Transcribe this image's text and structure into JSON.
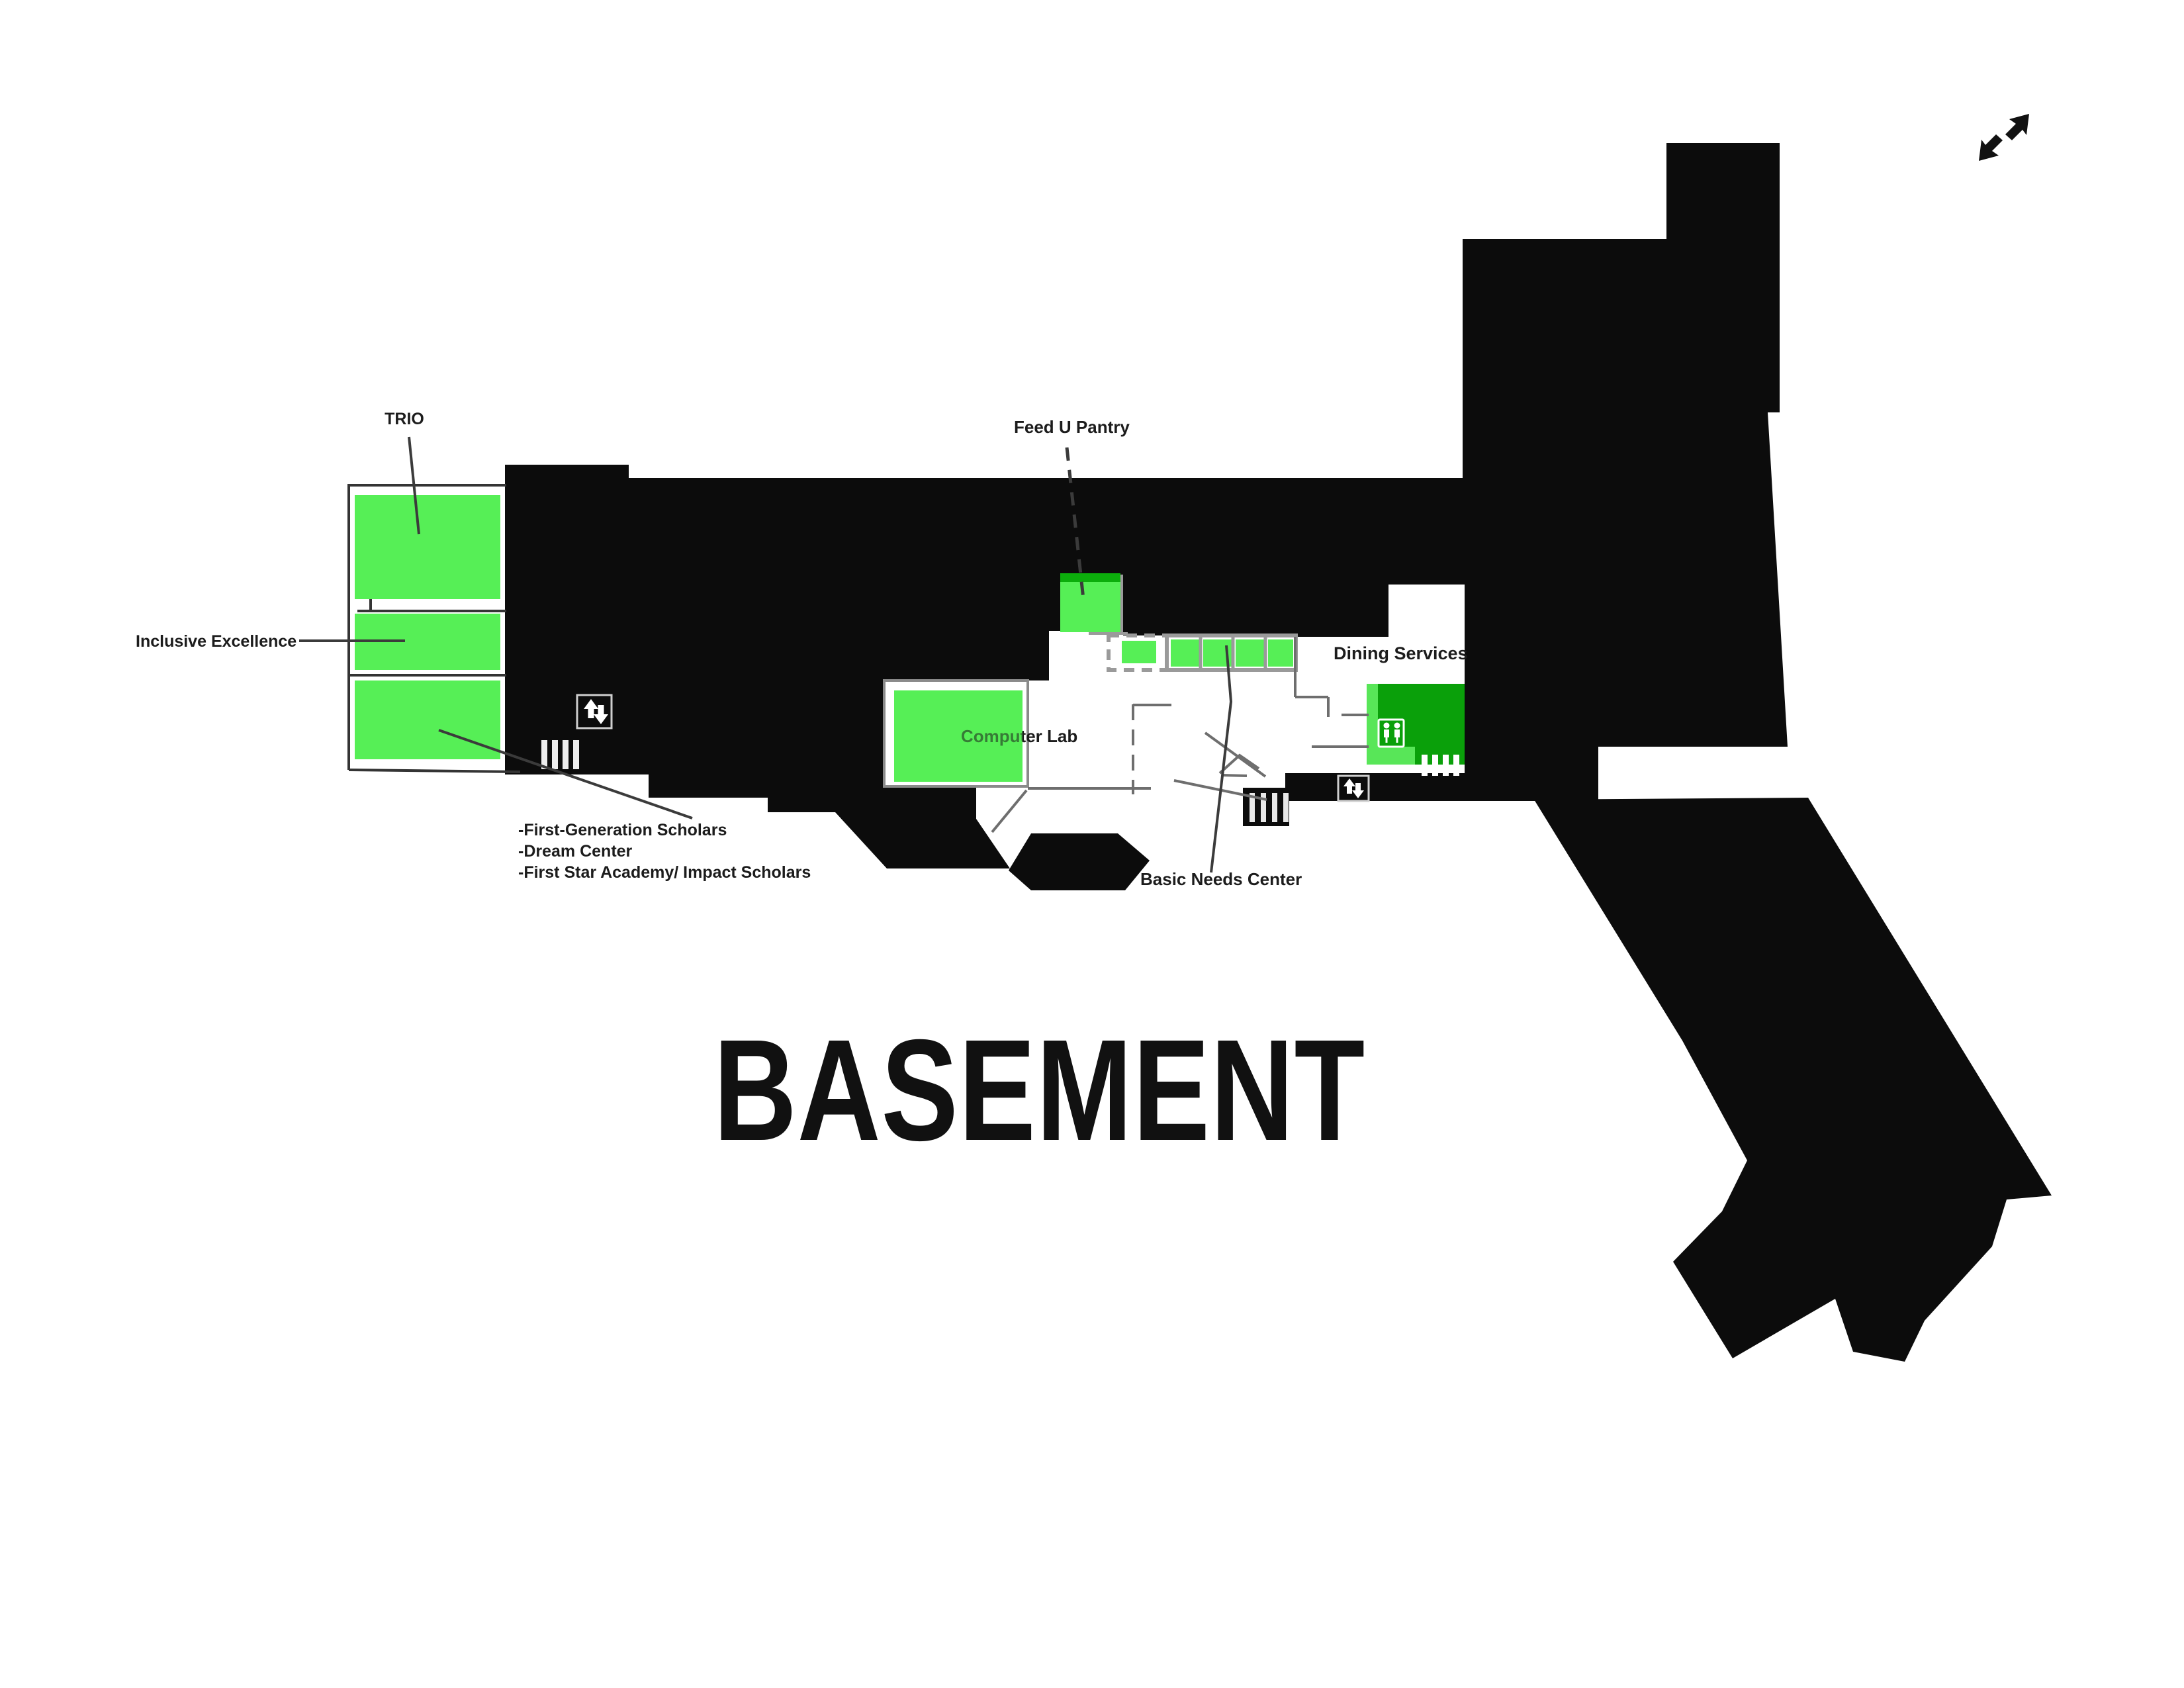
{
  "title": {
    "text": "BASEMENT"
  },
  "labels": {
    "trio": "TRIO",
    "inclusive_excellence": "Inclusive Excellence",
    "feed_u_pantry": "Feed U Pantry",
    "computer_lab": "Computer Lab",
    "dining_services": "Dining Services",
    "basic_needs_center": "Basic Needs Center",
    "annotation_lines": [
      "-First-Generation Scholars",
      "-Dream Center",
      "-First Star Academy/ Impact Scholars"
    ]
  },
  "rooms": [
    {
      "name": "TRIO upper room",
      "color_key": "room_green"
    },
    {
      "name": "TRIO middle room (Inclusive Excellence)",
      "color_key": "room_green"
    },
    {
      "name": "TRIO lower room (First-Generation Scholars / Dream Center / First Star Academy / Impact Scholars)",
      "color_key": "room_green"
    },
    {
      "name": "Feed U Pantry",
      "color_key": "room_green"
    },
    {
      "name": "Basic Needs Center rooms row",
      "color_key": "room_green"
    },
    {
      "name": "Computer Lab",
      "color_key": "room_green"
    },
    {
      "name": "Dining Services room",
      "color_key": "room_green_dark"
    }
  ],
  "icons": {
    "expand": "expand-arrows-icon",
    "elevator": "elevator-up-down-icon",
    "stairs": "stairs-icon",
    "restroom": "restroom-icon"
  },
  "colors": {
    "room_green": "#56ef56",
    "room_green_mid": "#0cae0c",
    "room_green_dark": "#0aa00a",
    "room_green_strip": "#58e658",
    "building_black": "#0c0c0c",
    "wall_gray": "#6e6e6e",
    "outline_gray": "#9a9a9a",
    "leader_dark": "#3b3b3b"
  }
}
